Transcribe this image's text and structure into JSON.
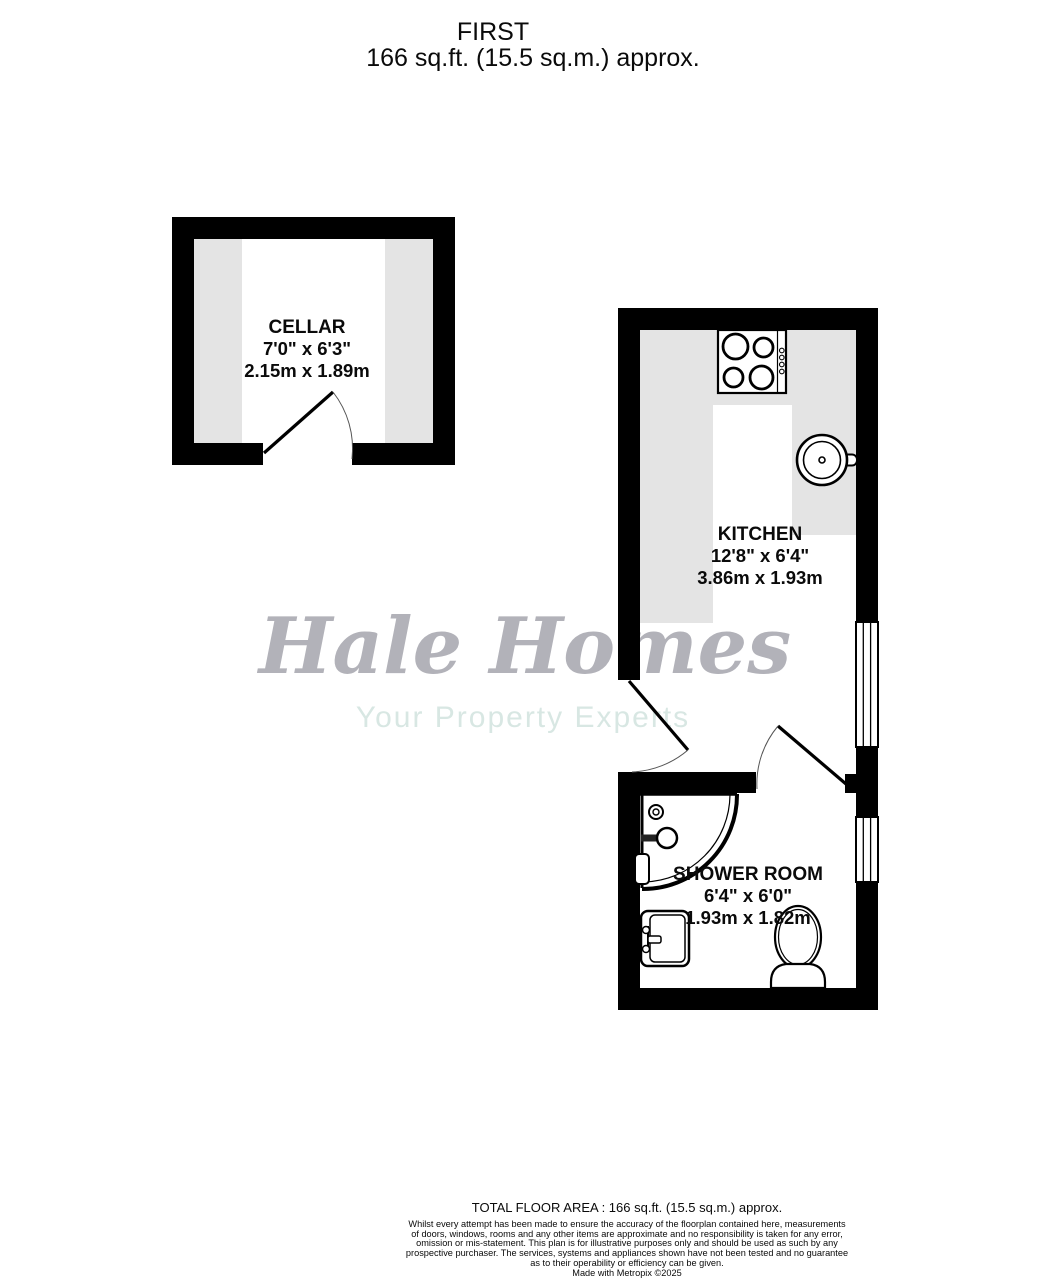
{
  "title": {
    "floor": "FIRST",
    "area": "166 sq.ft. (15.5 sq.m.) approx."
  },
  "watermark": {
    "brand": "Hale Homes",
    "tagline": "Your Property Experts"
  },
  "rooms": {
    "cellar": {
      "name": "CELLAR",
      "imperial": "7'0\"  x 6'3\"",
      "metric": "2.15m  x 1.89m"
    },
    "kitchen": {
      "name": "KITCHEN",
      "imperial": "12'8\"  x 6'4\"",
      "metric": "3.86m  x 1.93m"
    },
    "shower": {
      "name": "SHOWER ROOM",
      "imperial": "6'4\"  x 6'0\"",
      "metric": "1.93m  x 1.82m"
    }
  },
  "footer": {
    "total_area": "TOTAL FLOOR AREA : 166 sq.ft. (15.5 sq.m.) approx.",
    "disclaimer_lines": [
      "Whilst every attempt has been made to ensure the accuracy of the floorplan contained here, measurements",
      "of doors, windows, rooms and any other items are approximate and no responsibility is taken for any error,",
      "omission or mis-statement. This plan is for illustrative purposes only and should be used as such by any",
      "prospective purchaser. The services, systems and appliances shown have not been tested and no guarantee",
      "as to their operability or efficiency can be given.",
      "Made with Metropix ©2025"
    ]
  },
  "colors": {
    "wall": "#000000",
    "floor": "#ffffff",
    "counter_fill": "#e4e4e4",
    "watermark_brand": "#b2b2b9",
    "watermark_tagline": "#d8e7e3"
  }
}
